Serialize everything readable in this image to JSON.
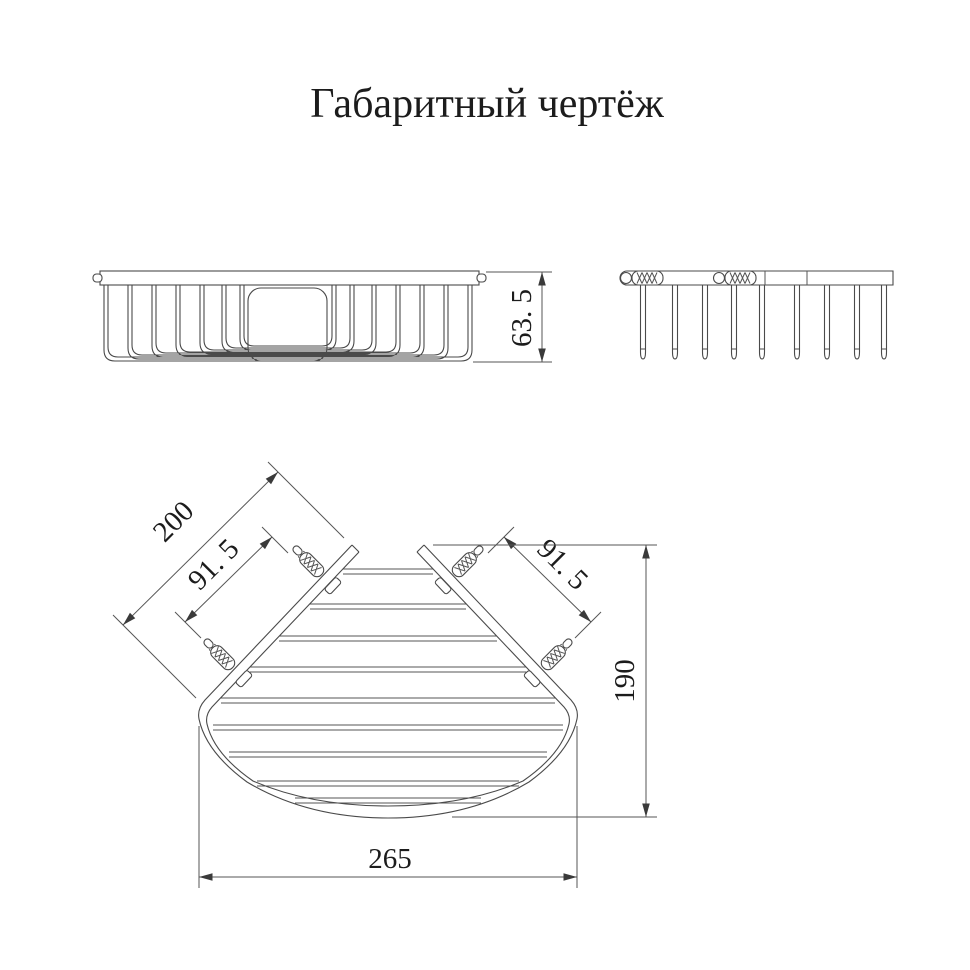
{
  "title": "Габаритный чертёж",
  "views": {
    "front": {
      "dims": {
        "height": "63. 5"
      }
    },
    "plan": {
      "dims": {
        "rail_length": "200",
        "left_plug_spacing": "91. 5",
        "right_plug_spacing": "91. 5",
        "depth": "190",
        "width": "265"
      }
    }
  },
  "colors": {
    "background": "#ffffff",
    "line": "#4a4a4a",
    "text": "#1c1c1c"
  }
}
